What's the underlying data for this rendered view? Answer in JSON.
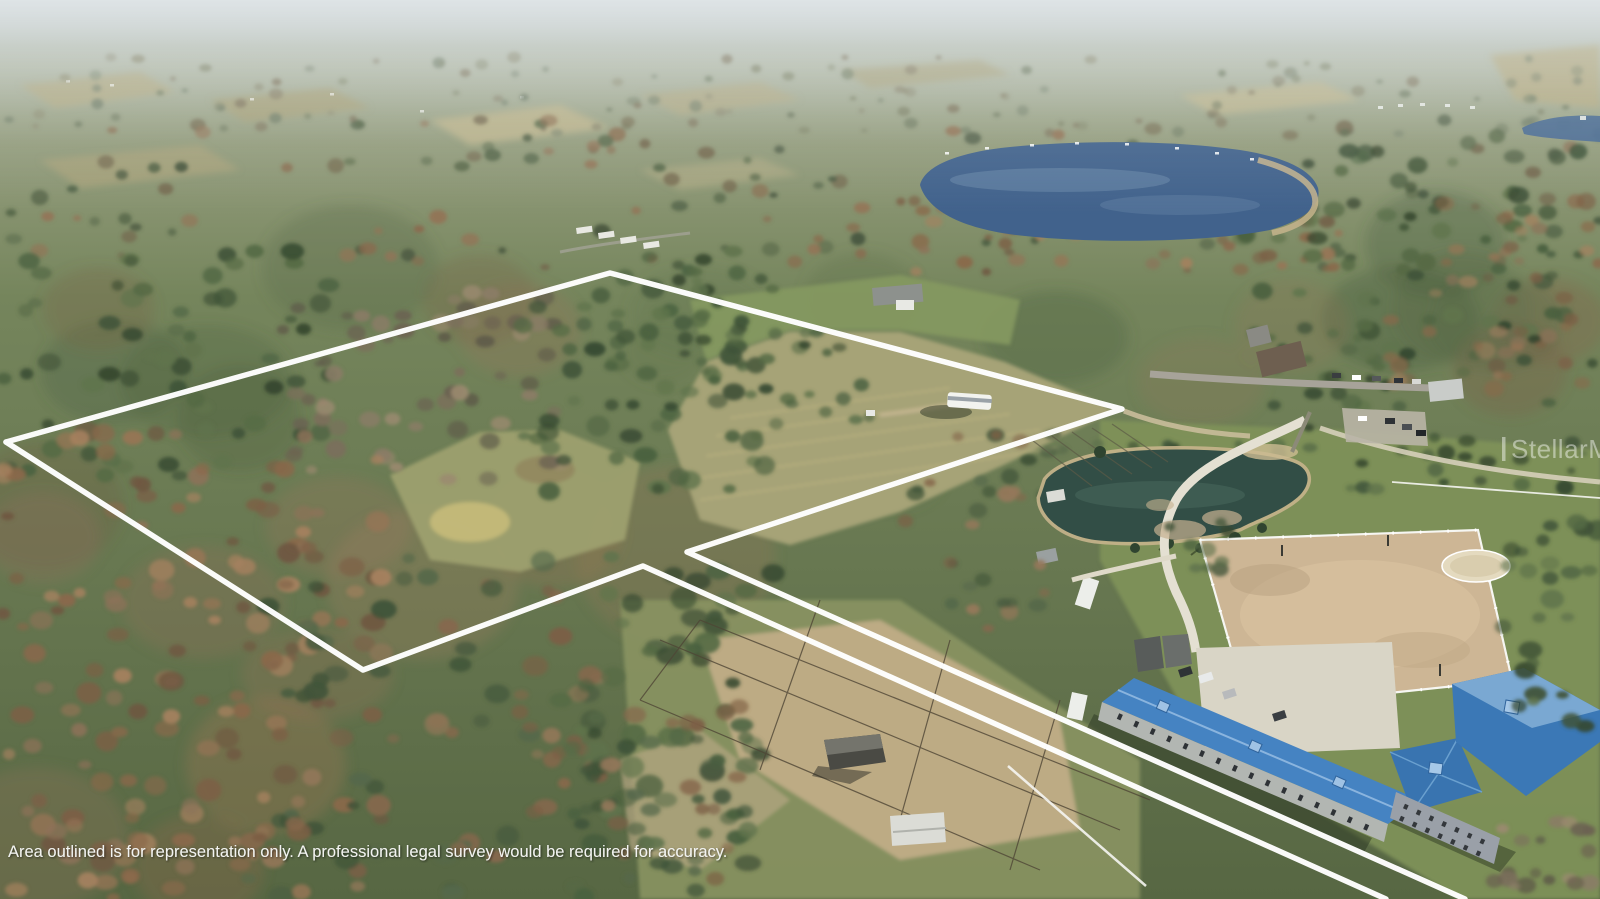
{
  "photo": {
    "kind": "aerial-drone-listing-photo",
    "features": [
      "wooded acreage with white property boundary outline",
      "two outlined parcels with access strip to road",
      "large lake",
      "farm pond",
      "riding arena",
      "round pen",
      "blue-roofed horse barn and stable wing",
      "gravel parking lot",
      "paddocks with run-in shed",
      "RV in field",
      "country roads and neighboring homes"
    ]
  },
  "overlay": {
    "disclaimer": "Area outlined is for representation only. A professional legal survey would be required for accuracy.",
    "watermark": "StellarMLS"
  },
  "colors": {
    "outline": "#ffffff",
    "lake": "#41628c",
    "lake_sheen": "#6d8cab",
    "second_lake": "#4a6b92",
    "pond": "#324e46",
    "pond_sheen": "#4a6a5d",
    "shore_sand": "#c6b48c",
    "field_olive": "#a6a377",
    "clearing": "#9da06f",
    "lawn": "#85995f",
    "grass": "#7e9159",
    "paddock_dirt": "#c3ae8a",
    "arena_sand": "#cdb695",
    "round_pen": "#e4dabf",
    "gravel": "#e4e0d2",
    "road": "#a7a399",
    "parking": "#d9d5c6",
    "barn_roof": "#4583c2",
    "barn_roof_light": "#7aa8d2",
    "barn_roof_dark": "#3b78b6",
    "barn_wall": "#b2b6b2",
    "house_wall": "#9aa0a8",
    "shed_white": "#dbdcd6",
    "shed_grey": "#9aa0a0",
    "run_in_roof": "#4a4a44",
    "fence_white": "#f6f6f2",
    "fence_dark": "#4f4636",
    "palettes": {
      "distant": [
        "#73806a",
        "#7f8468",
        "#8c8a70",
        "#6c785e",
        "#80765e"
      ],
      "band": [
        "#4e5f44",
        "#5a6a4b",
        "#74694f",
        "#8a6a4e",
        "#47553e",
        "#937457"
      ],
      "green": [
        "#3f5338",
        "#49603f",
        "#556a45",
        "#35472f",
        "#60744c"
      ],
      "rust": [
        "#8a684a",
        "#977555",
        "#7c5f45",
        "#a5815f",
        "#6f5741",
        "#8d7258"
      ],
      "scrub": [
        "#7b6f5b",
        "#8a7c66",
        "#6b6251",
        "#9b8a70",
        "#5d5848"
      ],
      "mix": [
        "#4a5c40",
        "#86684c",
        "#55684a",
        "#7c5f45",
        "#3f5338",
        "#95785a"
      ]
    }
  }
}
